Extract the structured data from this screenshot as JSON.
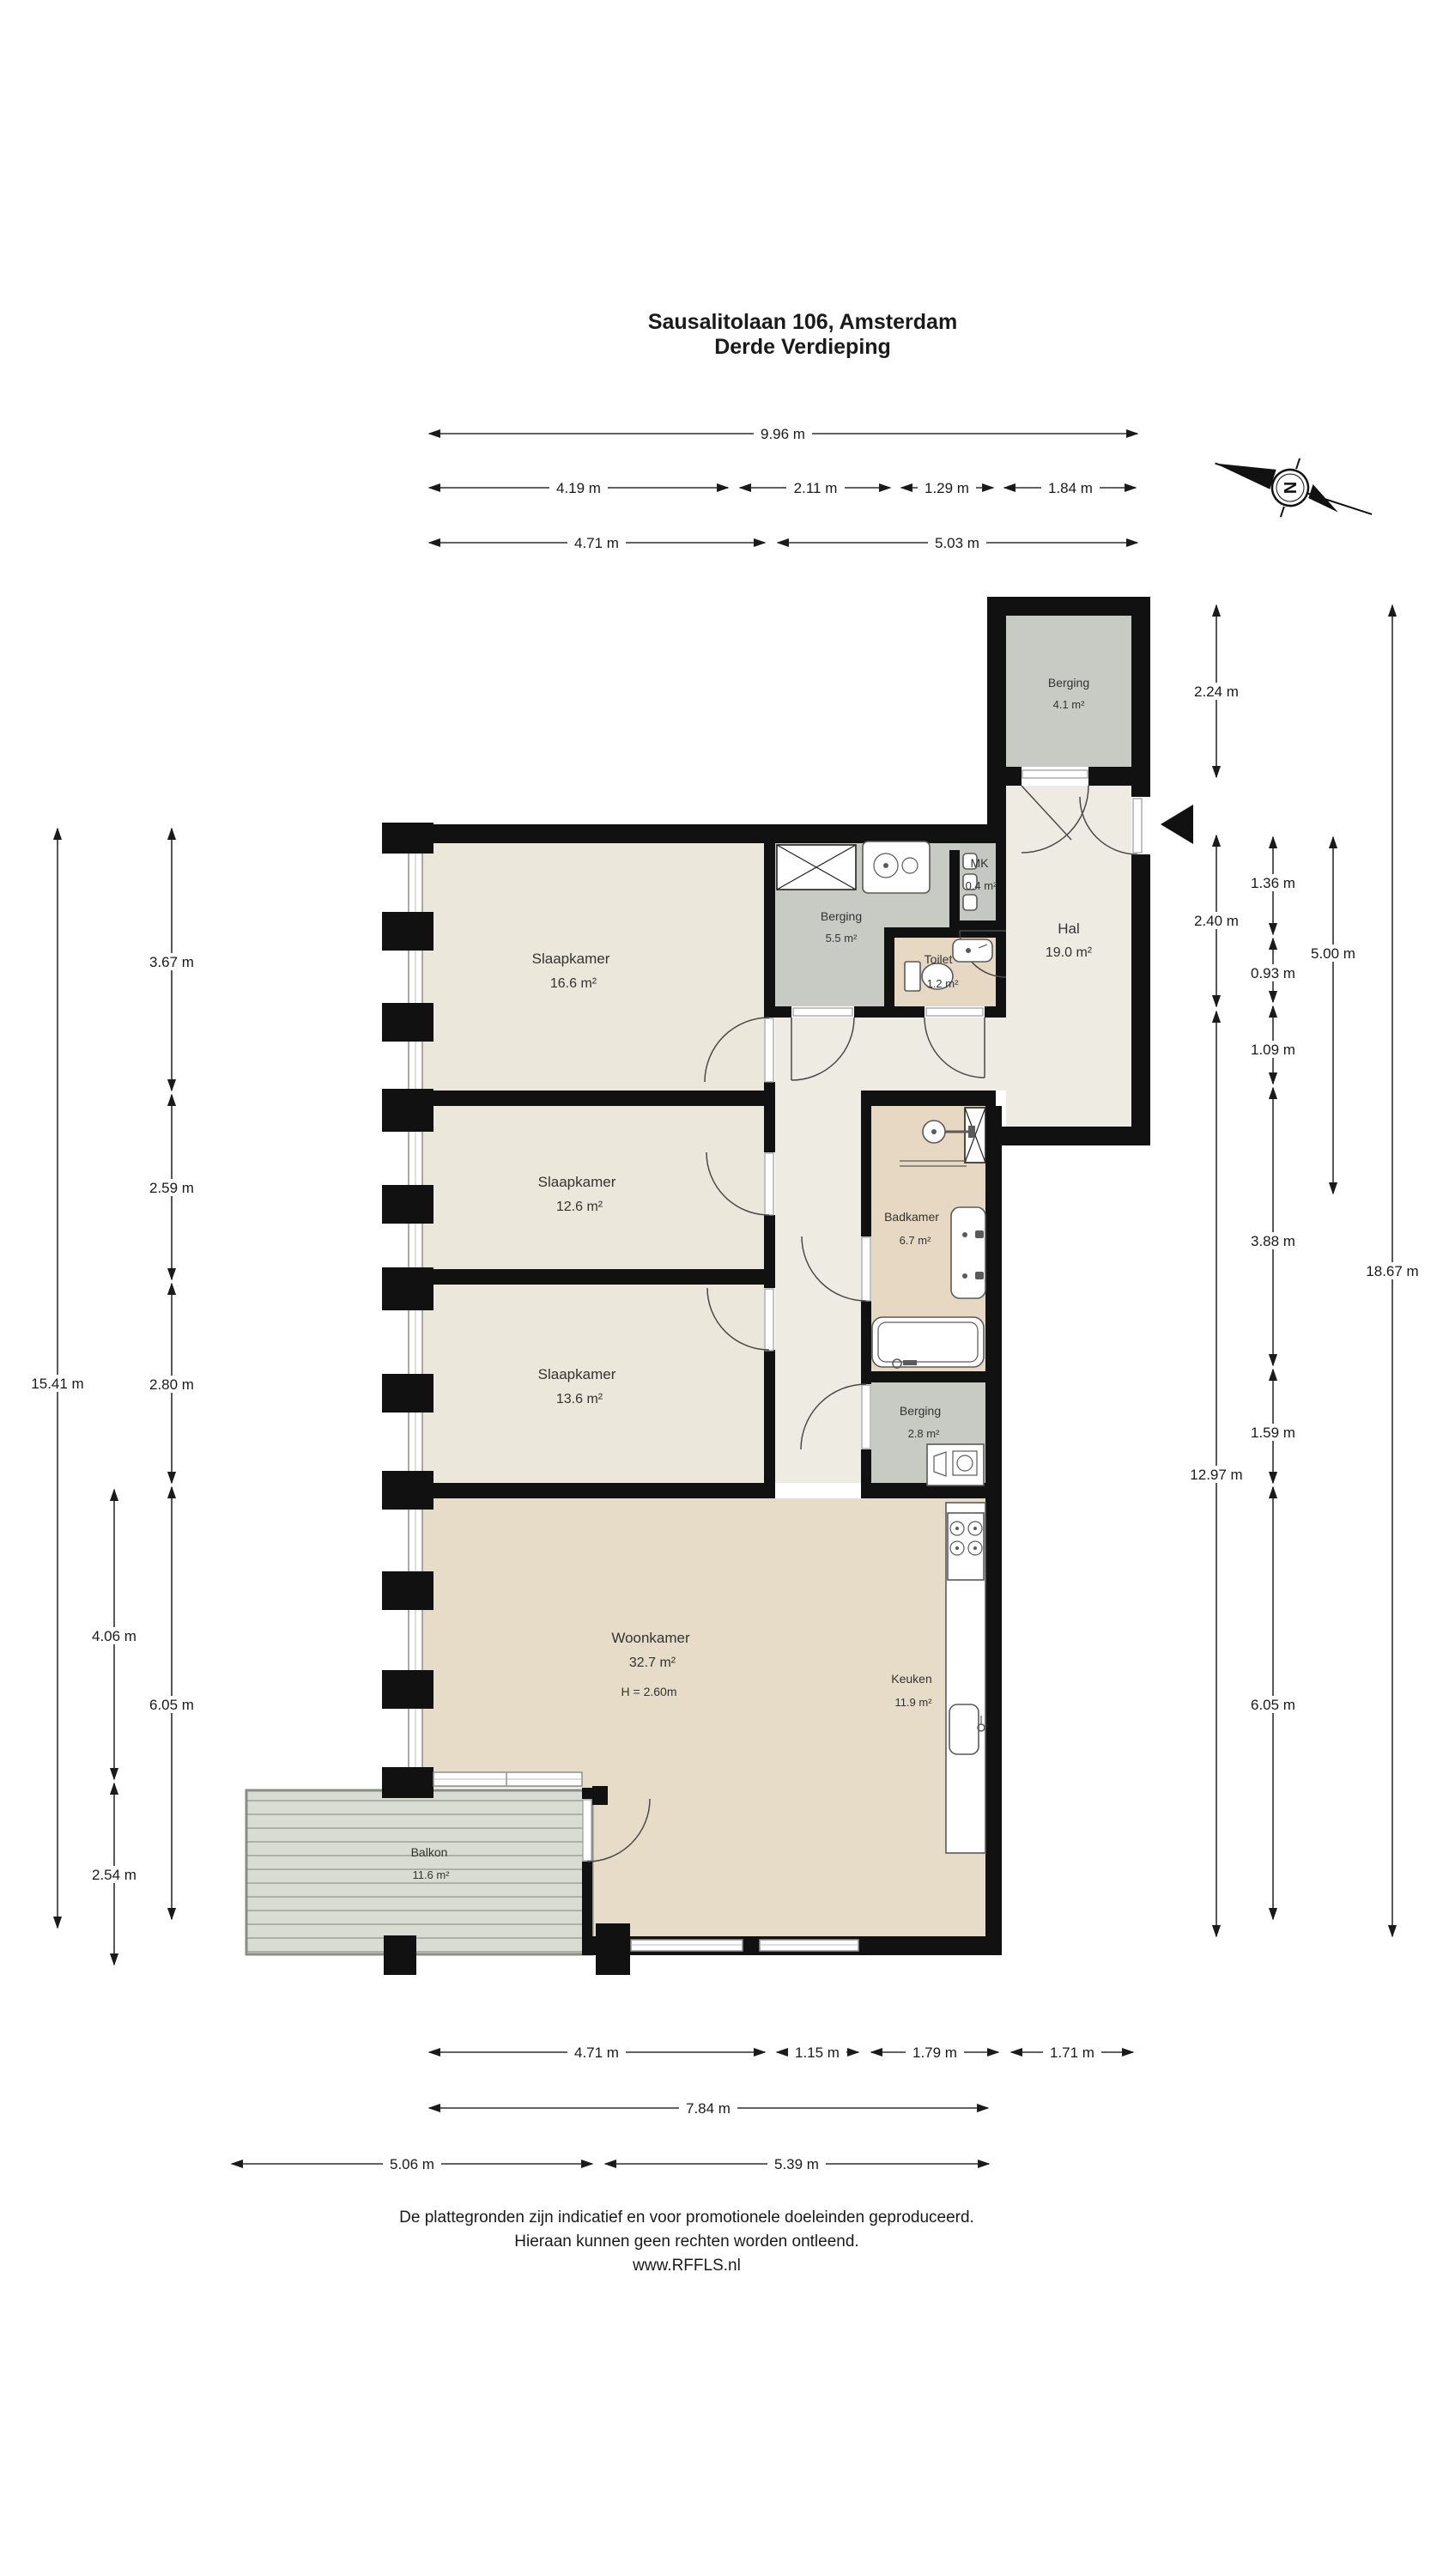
{
  "title": {
    "line1": "Sausalitolaan 106, Amsterdam",
    "line2": "Derde Verdieping"
  },
  "compass": {
    "north_label": "N"
  },
  "rooms": {
    "berging_top": {
      "name": "Berging",
      "area": "4.1 m²"
    },
    "hal": {
      "name": "Hal",
      "area": "19.0 m²"
    },
    "slaapkamer_1": {
      "name": "Slaapkamer",
      "area": "16.6 m²"
    },
    "berging_mid": {
      "name": "Berging",
      "area": "5.5 m²"
    },
    "mk": {
      "name": "MK",
      "area": "0.4 m²"
    },
    "toilet": {
      "name": "Toilet",
      "area": "1.2 m²"
    },
    "slaapkamer_2": {
      "name": "Slaapkamer",
      "area": "12.6 m²"
    },
    "badkamer": {
      "name": "Badkamer",
      "area": "6.7 m²"
    },
    "slaapkamer_3": {
      "name": "Slaapkamer",
      "area": "13.6 m²"
    },
    "berging_small": {
      "name": "Berging",
      "area": "2.8 m²"
    },
    "woonkamer": {
      "name": "Woonkamer",
      "area": "32.7 m²",
      "ceiling_height": "H = 2.60m"
    },
    "keuken": {
      "name": "Keuken",
      "area": "11.9 m²"
    },
    "balkon": {
      "name": "Balkon",
      "area": "11.6 m²"
    }
  },
  "dimensions": {
    "top": {
      "total": "9.96 m",
      "row2": [
        "4.19 m",
        "2.11 m",
        "1.29 m",
        "1.84 m"
      ],
      "row3": [
        "4.71 m",
        "5.03 m"
      ]
    },
    "bottom": {
      "row1": [
        "4.71 m",
        "1.15 m",
        "1.79 m",
        "1.71 m"
      ],
      "row2": "7.84 m",
      "row3": [
        "5.06 m",
        "5.39 m"
      ]
    },
    "left": {
      "outer": "15.41 m",
      "mid": [
        "4.06 m",
        "2.54 m"
      ],
      "inner": [
        "3.67 m",
        "2.59 m",
        "2.80 m",
        "6.05 m"
      ]
    },
    "right": {
      "col_a": [
        "2.24 m",
        "2.40 m",
        "12.97 m"
      ],
      "col_b": [
        "1.36 m",
        "0.93 m",
        "1.09 m",
        "3.88 m",
        "1.59 m",
        "6.05 m"
      ],
      "col_c": "5.00 m",
      "col_d": "18.67 m"
    }
  },
  "footer": {
    "line1": "De plattegronden zijn indicatief en voor promotionele doeleinden geproduceerd.",
    "line2": "Hieraan kunnen geen rechten worden ontleend.",
    "line3": "www.RFFLS.nl"
  },
  "colors": {
    "wall": "#111111",
    "hall_cream": "#edebe2",
    "bedroom_cream": "#ebe7da",
    "storage_gray": "#c8cbc4",
    "bathroom_tan": "#e6d8c2",
    "living_tan": "#e6dcc8",
    "balcony_gray_green": "#d9dcd3",
    "background": "#ffffff"
  }
}
